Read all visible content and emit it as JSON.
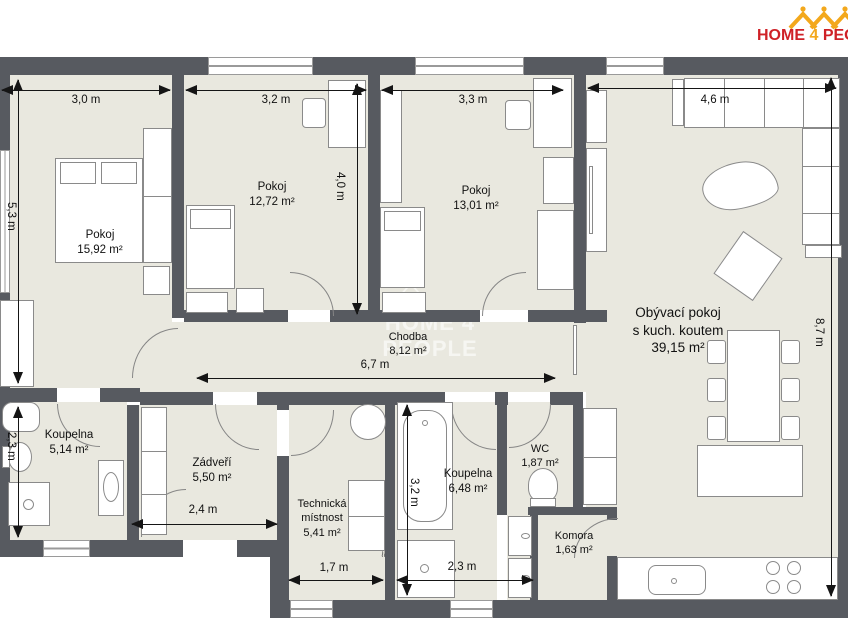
{
  "brand": {
    "home": "HOME",
    "four": "4",
    "people": "PEOPLE"
  },
  "watermark": {
    "text": "HOME 4 PEOPLE"
  },
  "rooms": {
    "pokoj1": {
      "name": "Pokoj",
      "area": "15,92 m²"
    },
    "pokoj2": {
      "name": "Pokoj",
      "area": "12,72 m²"
    },
    "pokoj3": {
      "name": "Pokoj",
      "area": "13,01 m²"
    },
    "living": {
      "line1": "Obývací pokoj",
      "line2": "s kuch. koutem",
      "area": "39,15 m²"
    },
    "chodba": {
      "name": "Chodba",
      "area": "8,12 m²"
    },
    "koupelna1": {
      "name": "Koupelna",
      "area": "5,14 m²"
    },
    "zadveri": {
      "name": "Zádveří",
      "area": "5,50 m²"
    },
    "technicka": {
      "line1": "Technická",
      "line2": "místnost",
      "area": "5,41 m²"
    },
    "koupelna2": {
      "name": "Koupelna",
      "area": "6,48 m²"
    },
    "wc": {
      "name": "WC",
      "area": "1,87 m²"
    },
    "komora": {
      "name": "Komora",
      "area": "1,63 m²"
    }
  },
  "dimensions": {
    "top_room1": "3,0 m",
    "top_room2": "3,2 m",
    "top_room3": "3,3 m",
    "top_living": "4,6 m",
    "left_room1": "5,3 m",
    "left_bath": "2,3 m",
    "room2_depth": "4,0 m",
    "right_living": "8,7 m",
    "corridor": "6,7 m",
    "zadveri_w": "2,4 m",
    "technicka_w": "1,7 m",
    "bath2_h": "3,2 m",
    "bath2_w": "2,3 m"
  },
  "colors": {
    "wall": "#575a60",
    "floor": "#e9e8df",
    "brand_red": "#cf2127",
    "brand_gold": "#f3a81c",
    "dimension": "#151515"
  }
}
